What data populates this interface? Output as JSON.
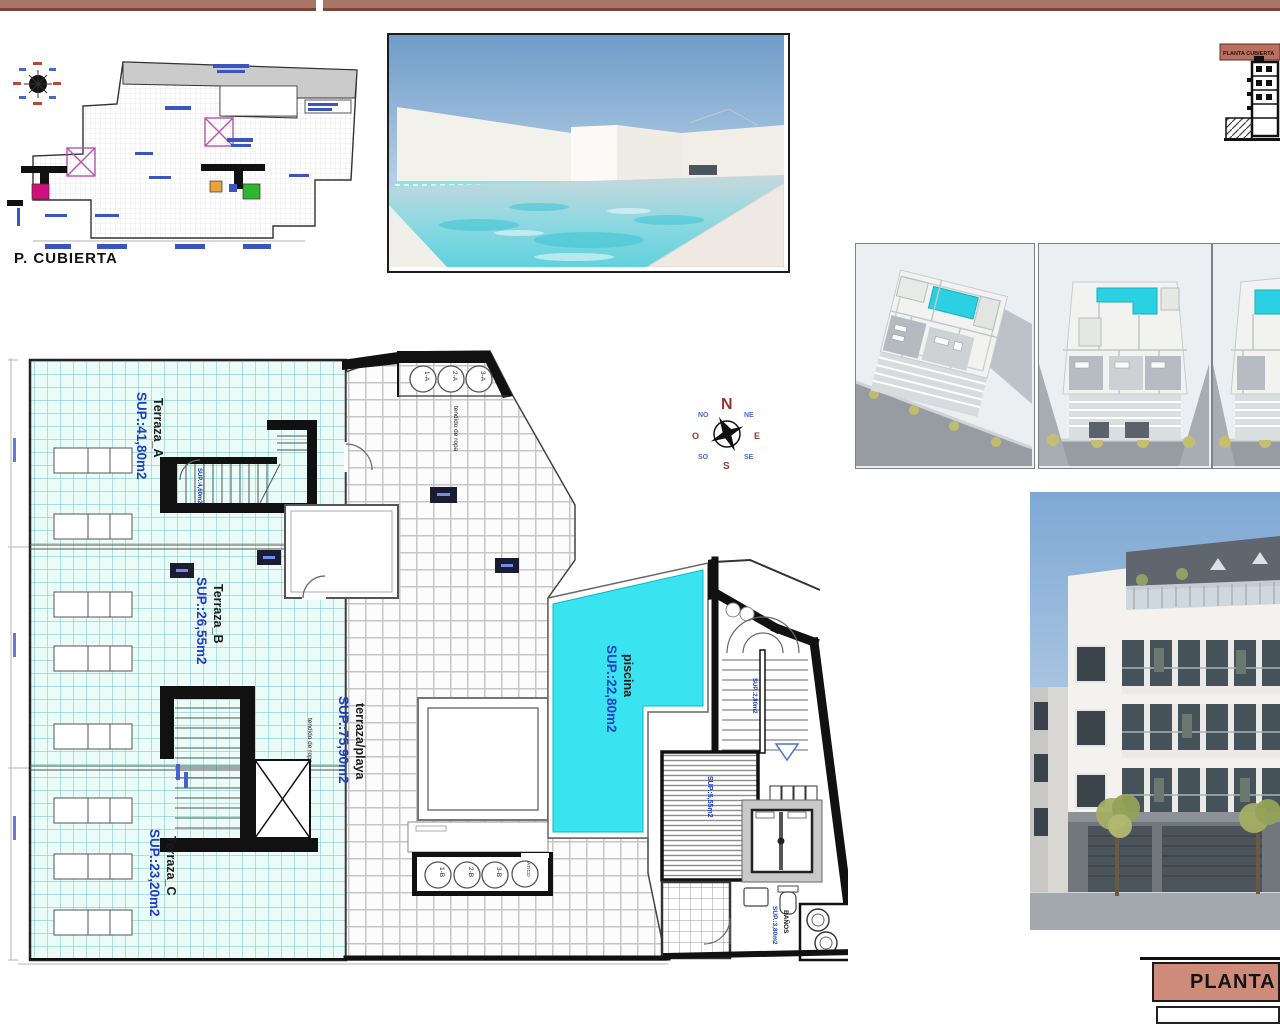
{
  "mini_plan": {
    "caption": "P. CUBIERTA"
  },
  "section_thumb": {
    "label": "PLANTA CUBIERTA"
  },
  "compass": {
    "n": "N",
    "ne": "NE",
    "e": "E",
    "se": "SE",
    "s": "S",
    "so": "SO",
    "o": "O",
    "no": "NO"
  },
  "floor_plan": {
    "terraces": [
      {
        "name": "Terraza_A",
        "area": "SUP.:41,80m2"
      },
      {
        "name": "Terraza_B",
        "area": "SUP.:26,55m2"
      },
      {
        "name": "Terraza_C",
        "area": "SUP.:23,20m2"
      }
    ],
    "beach_terrace": {
      "name": "terraza/playa",
      "area": "SUP.:75,90m2"
    },
    "pool": {
      "name": "piscina",
      "area": "SUP.:22,80m2"
    },
    "bathroom": {
      "name": "BAÑOS",
      "area": "SUP.:3,80m2"
    },
    "storage_area": "SUP.:5,55m2",
    "stair_a_area": "SUP.:4,60m2",
    "core_area": "SUP.:2,80m2",
    "laundry_label": "tendido de ropa",
    "skylights_top": [
      "1-A",
      "2-A",
      "3-A"
    ],
    "skylights_bottom": [
      "1-B",
      "2-B",
      "3-B",
      "ÁTICO"
    ]
  },
  "title_block": {
    "title": "PLANTA C"
  },
  "colors": {
    "pool": "#3AE3F0",
    "accent_bar": "#A97568",
    "title_bg": "#CF8B79",
    "label_blue": "#1E3EC6"
  }
}
